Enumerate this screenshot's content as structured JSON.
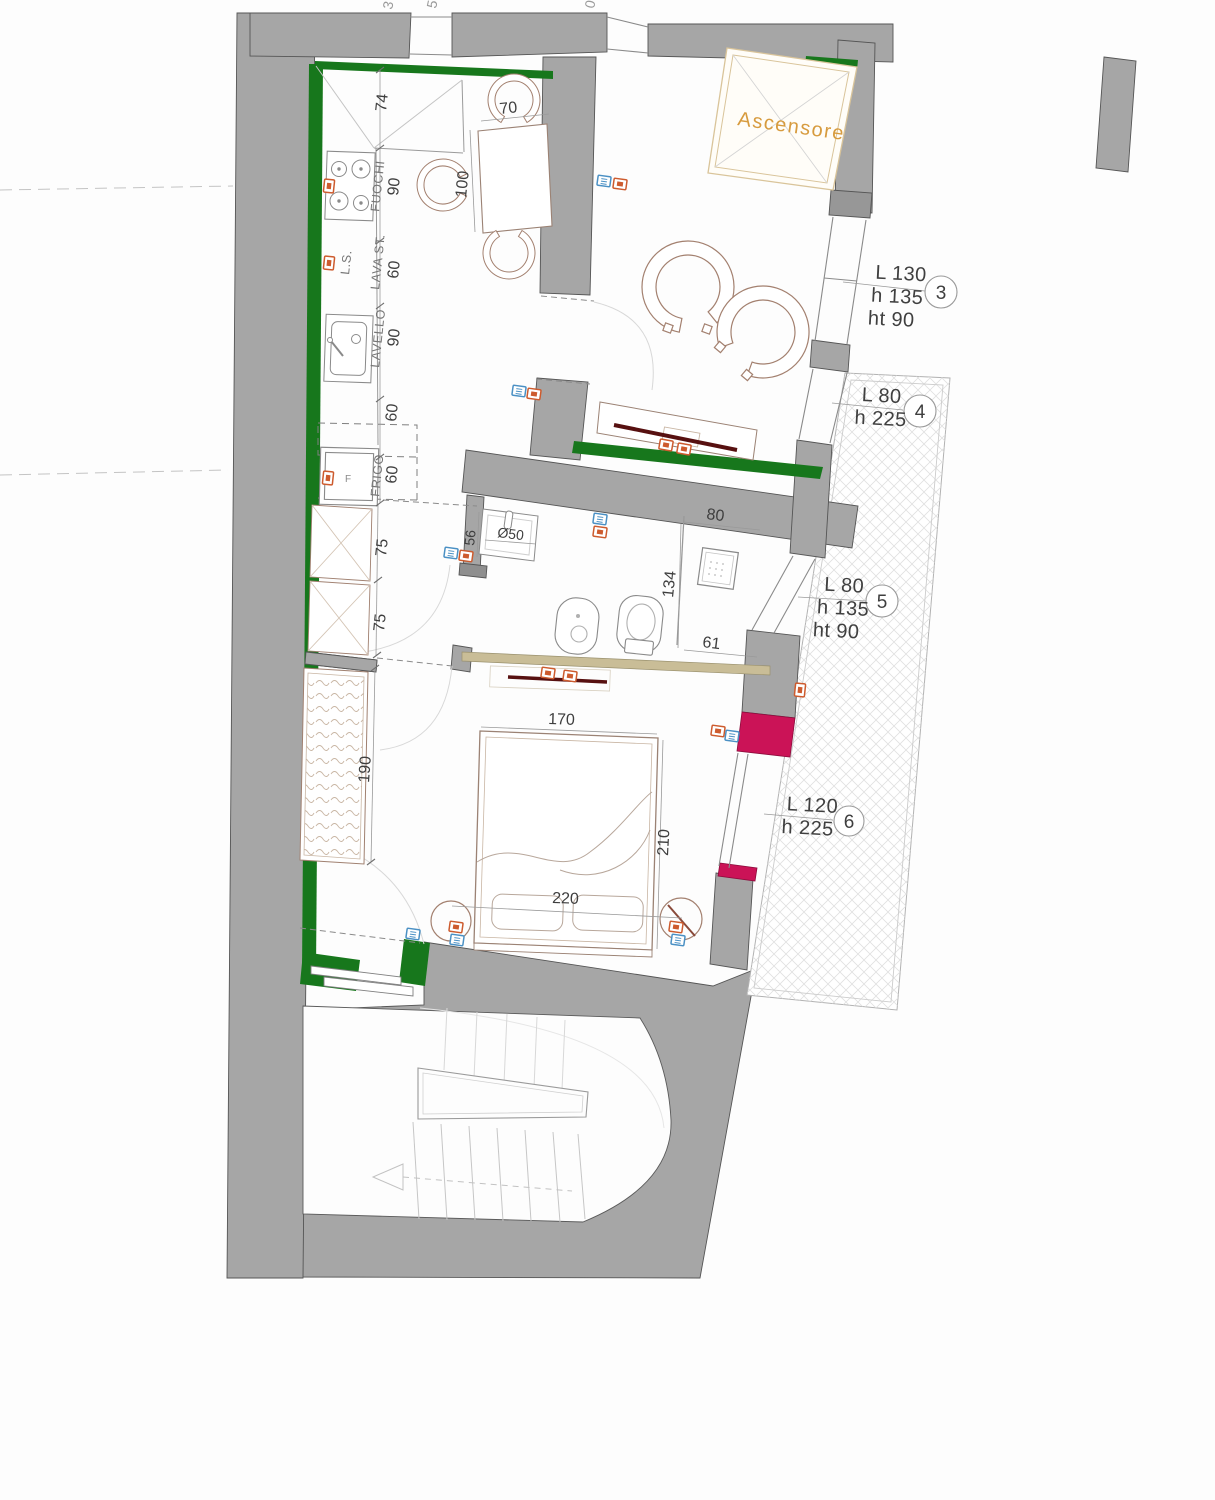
{
  "title": "Apartment floor plan",
  "elevator": {
    "label": "Ascensore"
  },
  "openings": [
    {
      "num": "3",
      "lines": [
        "L 130",
        "h 135",
        "ht 90"
      ]
    },
    {
      "num": "4",
      "lines": [
        "L 80",
        "h 225"
      ]
    },
    {
      "num": "5",
      "lines": [
        "L 80",
        "h 135",
        "ht 90"
      ]
    },
    {
      "num": "6",
      "lines": [
        "L 120",
        "h 225"
      ]
    }
  ],
  "kitchen": {
    "fuochi": "FUOCHI",
    "lava_st": "LAVA ST.",
    "ls": "L.S.",
    "lavello": "LAVELLO",
    "frigo": "FRIGO",
    "frigo_letter": "F"
  },
  "dims": {
    "corner": "74",
    "fuochi": "90",
    "lava": "60",
    "lavello": "90",
    "upper": "60",
    "frigo": "60",
    "tall1": "75",
    "tall2": "75",
    "wardrobe": "190",
    "table_w": "70",
    "table_l": "100",
    "basin_depth": "56",
    "basin_dia": "Ø50",
    "shower_w": "80",
    "shower_l": "134",
    "shower_b": "61",
    "bed_w": "170",
    "bed_l": "210",
    "bed_total": "220"
  },
  "edge_fragments": [
    "3",
    "5",
    "0"
  ],
  "colors": {
    "wall_gray": "#a6a6a6",
    "insulation_green": "#17771c",
    "accent_magenta": "#cb1357",
    "partition_tan": "#c9bd97",
    "elevator_orange": "#d79b3e",
    "tv_dark_red": "#571010",
    "icon_orange": "#cd5b2e",
    "icon_blue": "#4a90c4"
  }
}
